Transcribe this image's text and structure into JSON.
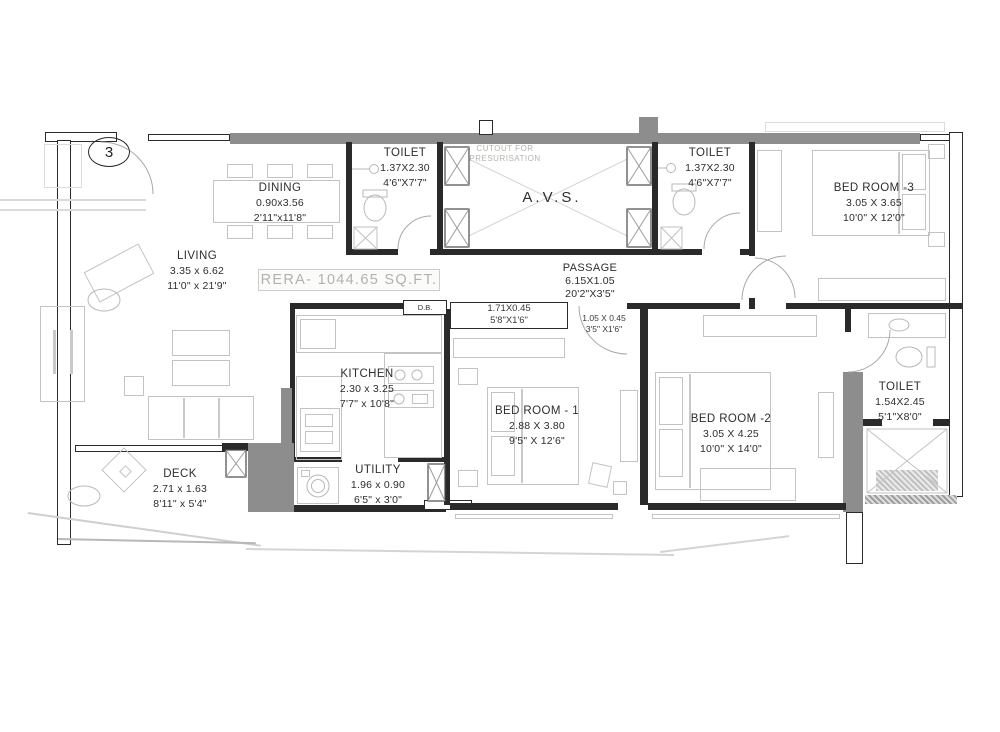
{
  "plan": {
    "unit_marker": "3",
    "rera_area_label": "RERA- 1044.65 SQ.FT.",
    "avs_label": "A.V.S.",
    "db_label": "D.B.",
    "cutout_note": {
      "line1": "CUTOUT FOR",
      "line2": "PRESURISATION"
    },
    "colors": {
      "wall_dark": "#2a2a2a",
      "wall_gray": "#8d8d8d",
      "furniture_line": "#c3c3c3",
      "label_text": "#2e2e2e",
      "faded_text": "#b5b3ae",
      "background": "#ffffff"
    },
    "rooms": {
      "living": {
        "name": "LIVING",
        "metric": "3.35 x 6.62",
        "imperial": "11'0\" x 21'9\""
      },
      "dining": {
        "name": "DINING",
        "metric": "0.90x3.56",
        "imperial": "2'11\"x11'8\""
      },
      "kitchen": {
        "name": "KITCHEN",
        "metric": "2.30 x 3.25",
        "imperial": "7'7\" x 10'8\""
      },
      "utility": {
        "name": "UTILITY",
        "metric": "1.96 x 0.90",
        "imperial": "6'5\" x 3'0\""
      },
      "deck": {
        "name": "DECK",
        "metric": "2.71 x 1.63",
        "imperial": "8'11\" x 5'4\""
      },
      "passage": {
        "name": "PASSAGE",
        "metric": "6.15X1.05",
        "imperial": "20'2\"X3'5\""
      },
      "bedroom1": {
        "name": "BED ROOM - 1",
        "metric": "2.88 X 3.80",
        "imperial": "9'5\" X 12'6\""
      },
      "bedroom2": {
        "name": "BED ROOM -2",
        "metric": "3.05 X 4.25",
        "imperial": "10'0\" X 14'0\""
      },
      "bedroom3": {
        "name": "BED ROOM -3",
        "metric": "3.05 X 3.65",
        "imperial": "10'0\" X 12'0\""
      },
      "toilet_top_left": {
        "name": "TOILET",
        "metric": "1.37X2.30",
        "imperial": "4'6\"X7'7\""
      },
      "toilet_top_right": {
        "name": "TOILET",
        "metric": "1.37X2.30",
        "imperial": "4'6\"X7'7\""
      },
      "toilet_right": {
        "name": "TOILET",
        "metric": "1.54X2.45",
        "imperial": "5'1\"X8'0\""
      }
    },
    "niches": {
      "large": {
        "metric": "1.71X0.45",
        "imperial": "5'8\"X1'6\""
      },
      "small": {
        "metric": "1.05 X 0.45",
        "imperial": "3'5\" X1'6\""
      }
    }
  }
}
